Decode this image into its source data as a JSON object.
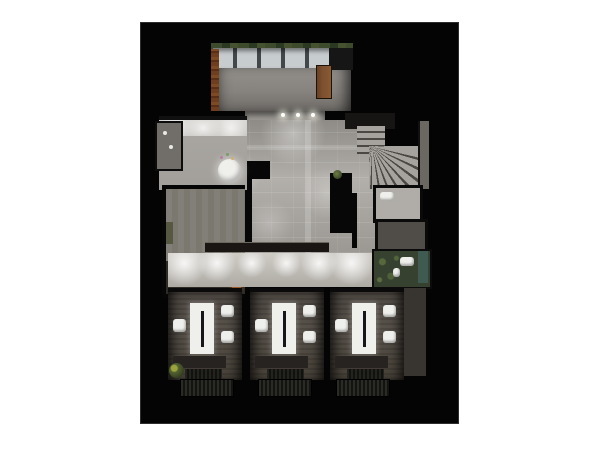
{
  "scene": {
    "type": "3d-floorplan-render",
    "description": "top-down dollhouse render of a floor, black background on white page",
    "canvas": {
      "x": 141,
      "y": 23,
      "width": 317,
      "height": 400
    },
    "bathroom_count": 3,
    "rooms": [
      "conservatory-glass-entry",
      "kitchen-bar",
      "main-hall",
      "lounge-carpet-room",
      "winding-staircase",
      "wc-under-stairs",
      "dark-storage",
      "green-wc",
      "lower-corridor",
      "shower-room-1",
      "shower-room-2",
      "shower-room-3"
    ],
    "colors": {
      "page-bg": "#ffffff",
      "canvas-bg": "#040404",
      "hall-floor": "#b2afaa",
      "hall-floor-edge": "#8e8b86",
      "corridor-floor": "#cfccc6",
      "kitchen-floor": "#a29f9a",
      "carpet": "#827f78",
      "brick": "#6e3e1f",
      "wood": "#7c5130",
      "wood-bright": "#9a5a2b",
      "stair-light": "#a6a39e",
      "stair-dark": "#4b4743",
      "bath-wall": "#57514a",
      "fixture-white": "#efefec",
      "counter-dark": "#191613",
      "plant": "#44502e",
      "wc-green": "#36422f",
      "teal": "#3f5a50"
    }
  }
}
